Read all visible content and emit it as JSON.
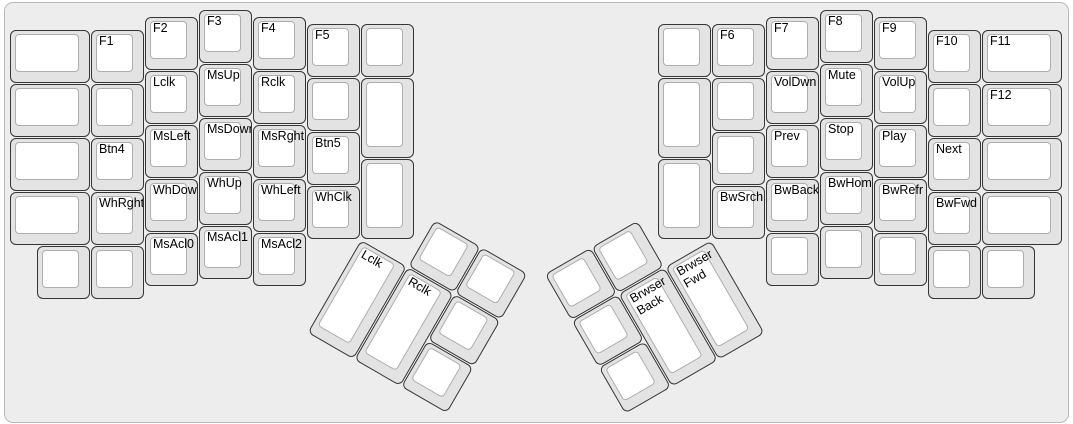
{
  "canvas": {
    "page_background": "#ffffff",
    "background": "#ededed",
    "border_color": "#b9b9b9",
    "key_side_color": "#e3e3e3",
    "key_border_color": "#353535",
    "key_top_color": "#ffffff",
    "key_top_border_color": "#aeaeae",
    "label_color": "#000000"
  },
  "layout": {
    "unit_px": 54,
    "margin_x": 10,
    "margin_y": 10
  },
  "groups": [
    {
      "name": "left-half-main-keys",
      "origin_x": 0,
      "origin_y": 0,
      "rotation": 0,
      "keys": [
        {
          "x": 0,
          "y": 0.375,
          "w": 1.5,
          "label": ""
        },
        {
          "x": 0,
          "y": 1.375,
          "w": 1.5,
          "label": ""
        },
        {
          "x": 0,
          "y": 2.375,
          "w": 1.5,
          "label": ""
        },
        {
          "x": 0,
          "y": 3.375,
          "w": 1.5,
          "label": ""
        },
        {
          "x": 0.5,
          "y": 4.375,
          "label": ""
        },
        {
          "x": 1.5,
          "y": 0.375,
          "label": "F1"
        },
        {
          "x": 1.5,
          "y": 1.375,
          "label": ""
        },
        {
          "x": 1.5,
          "y": 2.375,
          "label": "Btn4"
        },
        {
          "x": 1.5,
          "y": 3.375,
          "label": "WhRght"
        },
        {
          "x": 1.5,
          "y": 4.375,
          "label": ""
        },
        {
          "x": 2.5,
          "y": 0.125,
          "label": "F2"
        },
        {
          "x": 2.5,
          "y": 1.125,
          "label": "Lclk"
        },
        {
          "x": 2.5,
          "y": 2.125,
          "label": "MsLeft"
        },
        {
          "x": 2.5,
          "y": 3.125,
          "label": "WhDown"
        },
        {
          "x": 2.5,
          "y": 4.125,
          "label": "MsAcl0"
        },
        {
          "x": 3.5,
          "y": 0,
          "label": "F3"
        },
        {
          "x": 3.5,
          "y": 1,
          "label": "MsUp"
        },
        {
          "x": 3.5,
          "y": 2,
          "label": "MsDown"
        },
        {
          "x": 3.5,
          "y": 3,
          "label": "WhUp"
        },
        {
          "x": 3.5,
          "y": 4,
          "label": "MsAcl1"
        },
        {
          "x": 4.5,
          "y": 0.125,
          "label": "F4"
        },
        {
          "x": 4.5,
          "y": 1.125,
          "label": "Rclk"
        },
        {
          "x": 4.5,
          "y": 2.125,
          "label": "MsRght"
        },
        {
          "x": 4.5,
          "y": 3.125,
          "label": "WhLeft"
        },
        {
          "x": 4.5,
          "y": 4.125,
          "label": "MsAcl2"
        },
        {
          "x": 5.5,
          "y": 0.25,
          "label": "F5"
        },
        {
          "x": 5.5,
          "y": 1.25,
          "label": ""
        },
        {
          "x": 5.5,
          "y": 2.25,
          "label": "Btn5"
        },
        {
          "x": 5.5,
          "y": 3.25,
          "label": "WhClk"
        },
        {
          "x": 6.5,
          "y": 0.25,
          "label": ""
        },
        {
          "x": 6.5,
          "y": 1.25,
          "h": 1.5,
          "label": ""
        },
        {
          "x": 6.5,
          "y": 2.75,
          "h": 1.5,
          "label": ""
        }
      ]
    },
    {
      "name": "left-thumb-cluster",
      "origin_x": 6.5,
      "origin_y": 4.25,
      "rotation": 30,
      "keys": [
        {
          "x": 1,
          "y": -1,
          "label": ""
        },
        {
          "x": 2,
          "y": -1,
          "label": ""
        },
        {
          "x": 0,
          "y": 0,
          "h": 2,
          "label": "Lclk"
        },
        {
          "x": 1,
          "y": 0,
          "h": 2,
          "label": "Rclk"
        },
        {
          "x": 2,
          "y": 0,
          "label": ""
        },
        {
          "x": 2,
          "y": 1,
          "label": ""
        }
      ]
    },
    {
      "name": "right-half-main-keys",
      "origin_x": 12,
      "origin_y": 0,
      "rotation": 0,
      "keys": [
        {
          "x": 0,
          "y": 0.25,
          "label": ""
        },
        {
          "x": 0,
          "y": 1.25,
          "h": 1.5,
          "label": ""
        },
        {
          "x": 0,
          "y": 2.75,
          "h": 1.5,
          "label": ""
        },
        {
          "x": 1,
          "y": 0.25,
          "label": "F6"
        },
        {
          "x": 1,
          "y": 1.25,
          "label": ""
        },
        {
          "x": 1,
          "y": 2.25,
          "label": ""
        },
        {
          "x": 1,
          "y": 3.25,
          "label": "BwSrch"
        },
        {
          "x": 2,
          "y": 0.125,
          "label": "F7"
        },
        {
          "x": 2,
          "y": 1.125,
          "label": "VolDwn"
        },
        {
          "x": 2,
          "y": 2.125,
          "label": "Prev"
        },
        {
          "x": 2,
          "y": 3.125,
          "label": "BwBack"
        },
        {
          "x": 2,
          "y": 4.125,
          "label": ""
        },
        {
          "x": 3,
          "y": 0,
          "label": "F8"
        },
        {
          "x": 3,
          "y": 1,
          "label": "Mute"
        },
        {
          "x": 3,
          "y": 2,
          "label": "Stop"
        },
        {
          "x": 3,
          "y": 3,
          "label": "BwHome"
        },
        {
          "x": 3,
          "y": 4,
          "label": ""
        },
        {
          "x": 4,
          "y": 0.125,
          "label": "F9"
        },
        {
          "x": 4,
          "y": 1.125,
          "label": "VolUp"
        },
        {
          "x": 4,
          "y": 2.125,
          "label": "Play"
        },
        {
          "x": 4,
          "y": 3.125,
          "label": "BwRefr"
        },
        {
          "x": 4,
          "y": 4.125,
          "label": ""
        },
        {
          "x": 5,
          "y": 0.375,
          "label": "F10"
        },
        {
          "x": 5,
          "y": 1.375,
          "label": ""
        },
        {
          "x": 5,
          "y": 2.375,
          "label": "Next"
        },
        {
          "x": 5,
          "y": 3.375,
          "label": "BwFwd"
        },
        {
          "x": 5,
          "y": 4.375,
          "label": ""
        },
        {
          "x": 6,
          "y": 0.375,
          "w": 1.5,
          "label": "F11"
        },
        {
          "x": 6,
          "y": 1.375,
          "w": 1.5,
          "label": "F12"
        },
        {
          "x": 6,
          "y": 2.375,
          "w": 1.5,
          "label": ""
        },
        {
          "x": 6,
          "y": 3.375,
          "w": 1.5,
          "label": ""
        },
        {
          "x": 6,
          "y": 4.375,
          "label": ""
        }
      ]
    },
    {
      "name": "right-thumb-cluster",
      "origin_x": 13,
      "origin_y": 4.25,
      "rotation": -30,
      "keys": [
        {
          "x": -3,
          "y": -1,
          "label": ""
        },
        {
          "x": -2,
          "y": -1,
          "label": ""
        },
        {
          "x": -3,
          "y": 0,
          "label": ""
        },
        {
          "x": -2,
          "y": 0,
          "h": 2,
          "label": "Brwser\nBack"
        },
        {
          "x": -1,
          "y": 0,
          "h": 2,
          "label": "Brwser\nFwd"
        },
        {
          "x": -3,
          "y": 1,
          "label": ""
        }
      ]
    }
  ]
}
